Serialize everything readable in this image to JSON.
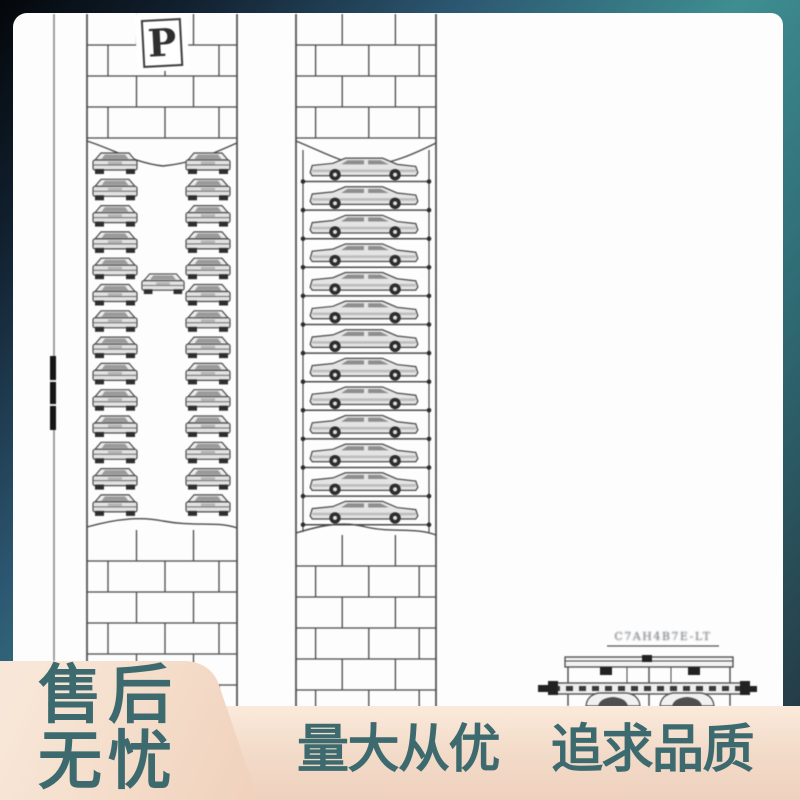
{
  "theme": {
    "accent_text": "#3d6a6e",
    "card_bg": "#fdfdfd",
    "line_color": "#4a4a4a",
    "frame_gradient_start": "#04070b",
    "frame_gradient_mid": "#3e8e91",
    "frame_gradient_end": "#22313c",
    "peach_light": "#f8e7d8",
    "peach_dark": "#f0d1bc"
  },
  "drawing": {
    "parking_sign": "P",
    "detail_label": "C7AH4B7E-LT",
    "left_tower": {
      "type": "rotary-carousel-front-view",
      "columns": 2,
      "cars_per_column": 14,
      "center_cars": 1,
      "top_brick_rows": 4,
      "bottom_brick_rows": 6
    },
    "right_tower": {
      "type": "stacker-side-view",
      "cars": 13,
      "top_brick_rows": 4,
      "bottom_brick_rows": 6
    }
  },
  "badges": {
    "after_sales_line1": "售后",
    "after_sales_line2": "无忧",
    "banner_left": "量大从优",
    "banner_right": "追求品质"
  }
}
